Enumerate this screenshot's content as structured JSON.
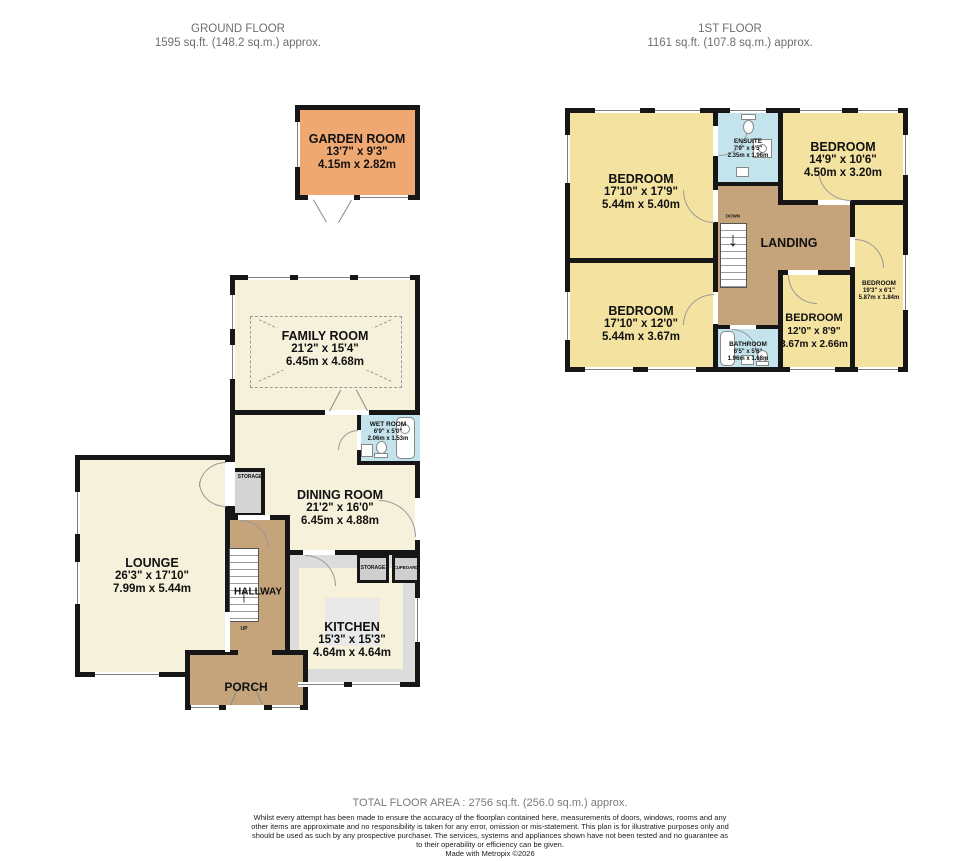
{
  "header": {
    "ground": {
      "title": "GROUND FLOOR",
      "area": "1595 sq.ft. (148.2 sq.m.) approx."
    },
    "first": {
      "title": "1ST FLOOR",
      "area": "1161 sq.ft. (107.8 sq.m.) approx."
    }
  },
  "colors": {
    "wall": "#161616",
    "cream": "#f6f1db",
    "bedroom_yellow": "#f3e2a0",
    "hall_tan": "#c5a37b",
    "garden_orange": "#f0a873",
    "bath_blue": "#c3e4ec",
    "storage_grey": "#d4d4d4"
  },
  "icons": {
    "up_arrow": "↑",
    "down_arrow": "↓"
  },
  "ground_floor": {
    "garden_room": {
      "name": "GARDEN ROOM",
      "imperial": "13'7\" x 9'3\"",
      "metric": "4.15m x 2.82m"
    },
    "family_room": {
      "name": "FAMILY ROOM",
      "imperial": "21'2\" x 15'4\"",
      "metric": "6.45m x 4.68m"
    },
    "wet_room": {
      "name": "WET ROOM",
      "imperial": "6'9\" x 5'0\"",
      "metric": "2.06m x 1.53m"
    },
    "dining_room": {
      "name": "DINING ROOM",
      "imperial": "21'2\" x 16'0\"",
      "metric": "6.45m x 4.88m"
    },
    "lounge": {
      "name": "LOUNGE",
      "imperial": "26'3\" x 17'10\"",
      "metric": "7.99m x 5.44m"
    },
    "hallway": {
      "name": "HALLWAY",
      "up_label": "UP"
    },
    "kitchen": {
      "name": "KITCHEN",
      "imperial": "15'3\" x 15'3\"",
      "metric": "4.64m x 4.64m"
    },
    "porch": {
      "name": "PORCH"
    },
    "storage_dining": {
      "name": "STORAGE"
    },
    "storage_kitchen": {
      "name": "STORAGE"
    },
    "cupboard": {
      "name": "CUPBOARD"
    }
  },
  "first_floor": {
    "bedroom_tl": {
      "name": "BEDROOM",
      "imperial": "17'10\" x 17'9\"",
      "metric": "5.44m x 5.40m"
    },
    "ensuite": {
      "name": "ENSUITE",
      "imperial": "7'9\" x 6'5\"",
      "metric": "2.35m x 1.96m"
    },
    "bedroom_tr": {
      "name": "BEDROOM",
      "imperial": "14'9\" x 10'6\"",
      "metric": "4.50m x 3.20m"
    },
    "landing": {
      "name": "LANDING",
      "down_label": "DOWN"
    },
    "bedroom_right": {
      "name": "BEDROOM",
      "imperial": "19'3\" x 6'1\"",
      "metric": "5.87m x 1.84m"
    },
    "bedroom_bl": {
      "name": "BEDROOM",
      "imperial": "17'10\" x 12'0\"",
      "metric": "5.44m x 3.67m"
    },
    "bathroom": {
      "name": "BATHROOM",
      "imperial": "6'5\" x 5'6\"",
      "metric": "1.96m x 1.68m"
    },
    "bedroom_bm": {
      "name": "BEDROOM",
      "imperial": "12'0\" x 8'9\"",
      "metric": "3.67m x 2.66m"
    }
  },
  "footer": {
    "total": "TOTAL FLOOR AREA : 2756 sq.ft. (256.0 sq.m.) approx.",
    "disclaimer": "Whilst every attempt has been made to ensure the accuracy of the floorplan contained here, measurements of doors, windows, rooms and any other items are approximate and no responsibility is taken for any error, omission or mis-statement. This plan is for illustrative purposes only and should be used as such by any prospective purchaser. The services, systems and appliances shown have not been tested and no guarantee as to their operability or efficiency can be given.",
    "credit": "Made with Metropix ©2026"
  }
}
